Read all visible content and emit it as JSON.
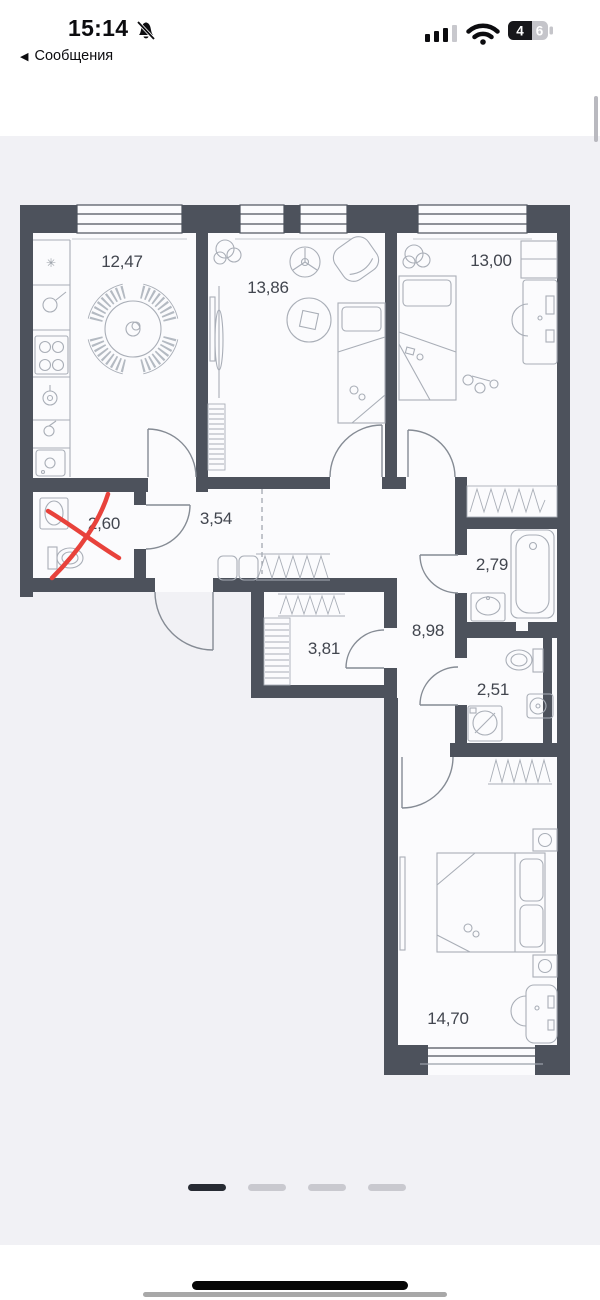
{
  "status_bar": {
    "time": "15:14",
    "muted_bell_icon": "bell-slash",
    "back_chevron": "◀",
    "back_label": "Сообщения",
    "signal_bars_filled": 3,
    "signal_bars_total": 4,
    "battery_digit_filled": "4",
    "battery_digit_empty": "6",
    "battery_level": "46"
  },
  "floor_plan": {
    "type": "apartment-floor-plan",
    "rooms": [
      {
        "name": "kitchen",
        "area": "12,47"
      },
      {
        "name": "living-room",
        "area": "13,86"
      },
      {
        "name": "bedroom-right",
        "area": "13,00"
      },
      {
        "name": "bathroom-crossed",
        "area": "2,60"
      },
      {
        "name": "hall",
        "area": "3,54"
      },
      {
        "name": "bathroom",
        "area": "2,79"
      },
      {
        "name": "hallway",
        "area": "8,98"
      },
      {
        "name": "storage",
        "area": "3,81"
      },
      {
        "name": "wc",
        "area": "2,51"
      },
      {
        "name": "bedroom-main",
        "area": "14,70"
      }
    ],
    "annotation": {
      "type": "red-cross-out",
      "target_room": "2,60",
      "color": "#e8423b"
    },
    "kitchen_icons": {
      "fridge_star": "✳"
    }
  },
  "carousel": {
    "page_count": 4,
    "active_index": 0
  },
  "colors": {
    "wall": "#4d525c",
    "furniture": "#a9aeb7",
    "cross": "#e8423b",
    "content_background": "#f1f1f5",
    "room_fill": "#fbfbfd",
    "active_dash": "#272b33",
    "inactive_dash": "#c9c9cf"
  }
}
